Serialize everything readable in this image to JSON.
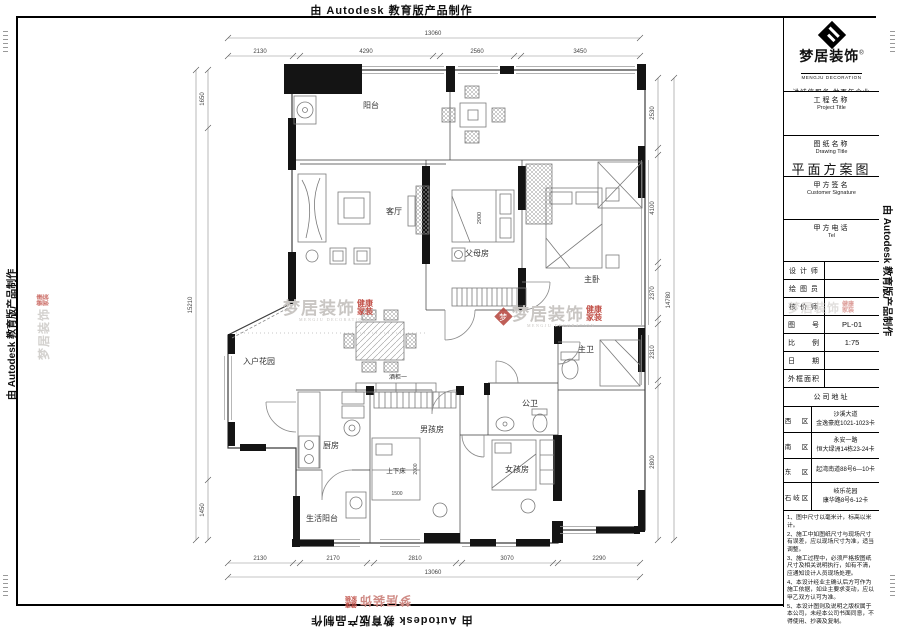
{
  "edges": {
    "autodesk": "由 Autodesk 教育版产品制作"
  },
  "watermark": {
    "brand": "梦居装饰",
    "sub1": "健康",
    "sub2": "家装",
    "en": "MENGJU DECORATION"
  },
  "title_block": {
    "logo": {
      "brand": "梦居装饰",
      "reg": "®",
      "en": "MENGJU DECORATION",
      "tagline": "讲诚信服务  做百年企业"
    },
    "fields": [
      {
        "label": "工程名称",
        "sublabel": "Project Title",
        "value": ""
      },
      {
        "label": "图纸名称",
        "sublabel": "Drawing Title",
        "value": "平面方案图"
      },
      {
        "label": "甲方签名",
        "sublabel": "Customer Signature",
        "value": ""
      },
      {
        "label": "甲方电话",
        "sublabel": "Tel",
        "value": ""
      }
    ],
    "info_rows": [
      {
        "label": "设 计 师",
        "value": ""
      },
      {
        "label": "绘 图 员",
        "value": ""
      },
      {
        "label": "核 价 师",
        "value": ""
      },
      {
        "label": "图　　号",
        "value": "PL-01"
      },
      {
        "label": "比　　例",
        "value": "1:75"
      },
      {
        "label": "日　　期",
        "value": ""
      },
      {
        "label": "外框面积",
        "value": ""
      }
    ],
    "address": {
      "header": "公司地址",
      "rows": [
        {
          "district": "西　区",
          "line1": "沙溪大道",
          "line2": "金逸豪庭1021-1023卡"
        },
        {
          "district": "南　区",
          "line1": "永安一路",
          "line2": "恒大绿洲14栋23-24卡"
        },
        {
          "district": "东　区",
          "line1": "起湾南道88号6—10卡",
          "line2": ""
        },
        {
          "district": "石岐区",
          "line1": "岐乐花园",
          "line2": "康华路8号6-12卡"
        }
      ]
    },
    "notes": [
      "1、图中尺寸以毫米计，标高以米计。",
      "2、施工中如图纸尺寸与现场尺寸有误差，应以现场尺寸为准，适当调整。",
      "3、施工过程中，必须严格按图纸尺寸及相关说明执行，如有不清，应通知设计人员现场处理。",
      "4、本设计经业主确认后方可作为施工依据，如业主要求变动，应以甲乙双方认可为准。",
      "5、本设计图则及说明之版权属于本公司，未经本公司书面同意，不得使用、抄袭及复制。"
    ]
  },
  "plan": {
    "rooms": {
      "balcony": "阳台",
      "living": "客厅",
      "parents": "父母房",
      "master": "主卧",
      "master_bath": "主卫",
      "entry_garden": "入户花园",
      "wine_cabinet": "酒柜一",
      "kitchen": "厨房",
      "boys": "男孩房",
      "bunk_bed": "上下床",
      "service_balcony": "生活阳台",
      "public_bath": "公卫",
      "girls": "女孩房"
    },
    "dims": {
      "top_total": "13060",
      "top": [
        "2130",
        "4290",
        "2560",
        "3450"
      ],
      "bottom": [
        "2130",
        "2170",
        "2810",
        "3070",
        "2290"
      ],
      "bottom_total": "13060",
      "right": [
        "2530",
        "4100",
        "2370",
        "2310",
        "2800"
      ],
      "right_total": "14780",
      "left_top": "1650",
      "left_total": "15210",
      "left_bottom": "1450",
      "parents_bed": "2900",
      "bunk_width": "1500",
      "bunk_length": "2000"
    }
  }
}
